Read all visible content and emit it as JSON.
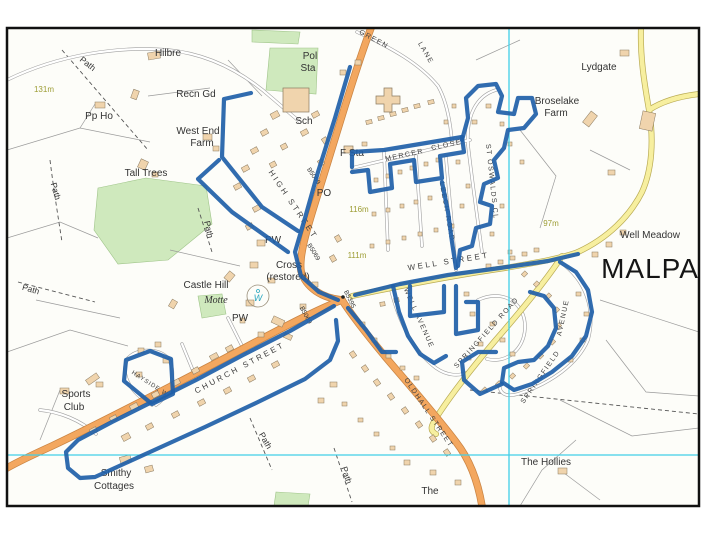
{
  "map": {
    "town_name": "MALPA",
    "description": "Street map of Malpas with blue highlighted walking route",
    "road_numbers": [
      "B5069",
      "B5395"
    ]
  },
  "colors": {
    "route_blue": "#1f5fa8",
    "road_orange": "#f3a75f",
    "road_orange_casing": "#c98443",
    "road_yellow": "#f7ef9f",
    "road_yellow_casing": "#b9ab54",
    "grid_cyan": "#41cfe8",
    "green_area": "#cfe9bd",
    "building": "#f0d4ad",
    "border": "#111111"
  },
  "grid": {
    "vertical_x": 509,
    "horizontal_y": 455
  },
  "labels": [
    {
      "t": "Hilbre",
      "x": 168,
      "y": 56,
      "r": 0,
      "c": "place"
    },
    {
      "t": "Path",
      "x": 86,
      "y": 66,
      "r": 38,
      "c": "path"
    },
    {
      "t": "131m",
      "x": 44,
      "y": 92,
      "r": 0,
      "c": "spot"
    },
    {
      "t": "Pp Ho",
      "x": 99,
      "y": 119,
      "r": 0,
      "c": "place"
    },
    {
      "t": "Recn Gd",
      "x": 196,
      "y": 97,
      "r": 0,
      "c": "place"
    },
    {
      "t": "West End",
      "x": 198,
      "y": 134,
      "r": 0,
      "c": "place"
    },
    {
      "t": "Farm",
      "x": 202,
      "y": 146,
      "r": 0,
      "c": "place"
    },
    {
      "t": "Tall Trees",
      "x": 146,
      "y": 176,
      "r": 0,
      "c": "place"
    },
    {
      "t": "Pol",
      "x": 310,
      "y": 59,
      "r": 0,
      "c": "place"
    },
    {
      "t": "Sta",
      "x": 308,
      "y": 71,
      "r": 0,
      "c": "place"
    },
    {
      "t": "Sch",
      "x": 304,
      "y": 124,
      "r": 0,
      "c": "place"
    },
    {
      "t": "F Sta",
      "x": 352,
      "y": 156,
      "r": 0,
      "c": "place"
    },
    {
      "t": "GREEN",
      "x": 373,
      "y": 41,
      "r": 28,
      "c": "street"
    },
    {
      "t": "LANE",
      "x": 424,
      "y": 54,
      "r": 60,
      "c": "street"
    },
    {
      "t": "Lydgate",
      "x": 599,
      "y": 70,
      "r": 0,
      "c": "place"
    },
    {
      "t": "Broselake",
      "x": 557,
      "y": 104,
      "r": 0,
      "c": "place"
    },
    {
      "t": "Farm",
      "x": 556,
      "y": 116,
      "r": 0,
      "c": "place"
    },
    {
      "t": "MERCER",
      "x": 405,
      "y": 157,
      "r": -12,
      "c": "street"
    },
    {
      "t": "CLOSE",
      "x": 447,
      "y": 147,
      "r": -12,
      "c": "street"
    },
    {
      "t": "LEECH ROAD",
      "x": 445,
      "y": 212,
      "r": 80,
      "c": "street"
    },
    {
      "t": "ST OSWALDS CL",
      "x": 490,
      "y": 182,
      "r": 84,
      "c": "street"
    },
    {
      "t": "HIGH STREET",
      "x": 291,
      "y": 206,
      "r": 56,
      "c": "street-lg"
    },
    {
      "t": "B5069",
      "x": 312,
      "y": 177,
      "r": 56,
      "c": "roadno"
    },
    {
      "t": "B5069",
      "x": 312,
      "y": 253,
      "r": 58,
      "c": "roadno"
    },
    {
      "t": "B5069",
      "x": 304,
      "y": 316,
      "r": 62,
      "c": "roadno"
    },
    {
      "t": "B5395",
      "x": 348,
      "y": 300,
      "r": 64,
      "c": "roadno"
    },
    {
      "t": "PO",
      "x": 324,
      "y": 196,
      "r": 0,
      "c": "place"
    },
    {
      "t": "116m",
      "x": 359,
      "y": 212,
      "r": 0,
      "c": "spot"
    },
    {
      "t": "111m",
      "x": 357,
      "y": 258,
      "r": 0,
      "c": "spot"
    },
    {
      "t": "97m",
      "x": 551,
      "y": 226,
      "r": 0,
      "c": "spot"
    },
    {
      "t": "PW",
      "x": 273,
      "y": 243,
      "r": 0,
      "c": "place"
    },
    {
      "t": "Cross",
      "x": 289,
      "y": 268,
      "r": 0,
      "c": "place"
    },
    {
      "t": "(restored)",
      "x": 288,
      "y": 280,
      "r": 0,
      "c": "place"
    },
    {
      "t": "Castle Hill",
      "x": 206,
      "y": 288,
      "r": 0,
      "c": "place"
    },
    {
      "t": "Motte",
      "x": 216,
      "y": 303,
      "r": 0,
      "c": "italic"
    },
    {
      "t": "W",
      "x": 258,
      "y": 301,
      "r": 0,
      "c": "well"
    },
    {
      "t": "PW",
      "x": 240,
      "y": 321,
      "r": 0,
      "c": "place"
    },
    {
      "t": "WELL STREET",
      "x": 449,
      "y": 264,
      "r": -9,
      "c": "street-lg"
    },
    {
      "t": "Well Meadow",
      "x": 650,
      "y": 238,
      "r": 0,
      "c": "place"
    },
    {
      "t": "MALPA",
      "x": 650,
      "y": 278,
      "r": 0,
      "c": "big"
    },
    {
      "t": "WELL AVENUE",
      "x": 417,
      "y": 319,
      "r": 66,
      "c": "street"
    },
    {
      "t": "SPRINGFIELD ROAD",
      "x": 488,
      "y": 334,
      "r": -48,
      "c": "street"
    },
    {
      "t": "SPRINGFIELD",
      "x": 542,
      "y": 378,
      "r": -55,
      "c": "street"
    },
    {
      "t": "AVENUE",
      "x": 565,
      "y": 318,
      "r": -78,
      "c": "street"
    },
    {
      "t": "OLDHALL STREET",
      "x": 427,
      "y": 414,
      "r": 56,
      "c": "street"
    },
    {
      "t": "CHURCH STREET",
      "x": 241,
      "y": 370,
      "r": -28,
      "c": "street-lg"
    },
    {
      "t": "HAYSIDE W",
      "x": 149,
      "y": 385,
      "r": 33,
      "c": "street-sm"
    },
    {
      "t": "Sports",
      "x": 76,
      "y": 397,
      "r": 0,
      "c": "place"
    },
    {
      "t": "Club",
      "x": 74,
      "y": 410,
      "r": 0,
      "c": "place"
    },
    {
      "t": "Smithy",
      "x": 116,
      "y": 476,
      "r": 0,
      "c": "place"
    },
    {
      "t": "Cottages",
      "x": 114,
      "y": 489,
      "r": 0,
      "c": "place"
    },
    {
      "t": "Path",
      "x": 53,
      "y": 192,
      "r": 74,
      "c": "path"
    },
    {
      "t": "Path",
      "x": 30,
      "y": 292,
      "r": 16,
      "c": "path"
    },
    {
      "t": "Path",
      "x": 206,
      "y": 230,
      "r": 78,
      "c": "path"
    },
    {
      "t": "Path",
      "x": 263,
      "y": 442,
      "r": 60,
      "c": "path"
    },
    {
      "t": "Path",
      "x": 344,
      "y": 476,
      "r": 72,
      "c": "path"
    },
    {
      "t": "The Hollies",
      "x": 546,
      "y": 465,
      "r": 0,
      "c": "place"
    },
    {
      "t": "The",
      "x": 430,
      "y": 494,
      "r": 0,
      "c": "place"
    }
  ],
  "route_overlay": {
    "color": "#1f5fa8",
    "width": 4.2,
    "paths": [
      [
        [
          350,
          67
        ],
        [
          335,
          118
        ],
        [
          318,
          172
        ],
        [
          305,
          218
        ],
        [
          295,
          252
        ],
        [
          301,
          276
        ],
        [
          319,
          292
        ],
        [
          338,
          300
        ]
      ],
      [
        [
          298,
          231
        ],
        [
          262,
          207
        ],
        [
          222,
          157
        ],
        [
          224,
          99
        ],
        [
          251,
          93
        ]
      ],
      [
        [
          288,
          252
        ],
        [
          232,
          212
        ],
        [
          198,
          179
        ],
        [
          219,
          160
        ]
      ],
      [
        [
          334,
          306
        ],
        [
          290,
          331
        ],
        [
          243,
          355
        ],
        [
          196,
          380
        ],
        [
          152,
          402
        ],
        [
          112,
          422
        ],
        [
          78,
          440
        ],
        [
          66,
          452
        ],
        [
          68,
          468
        ],
        [
          80,
          478
        ],
        [
          95,
          477
        ],
        [
          150,
          452
        ],
        [
          205,
          427
        ],
        [
          258,
          402
        ],
        [
          305,
          379
        ],
        [
          330,
          360
        ],
        [
          338,
          341
        ],
        [
          336,
          320
        ]
      ],
      [
        [
          152,
          404
        ],
        [
          124,
          381
        ],
        [
          126,
          360
        ],
        [
          150,
          351
        ],
        [
          171,
          359
        ],
        [
          173,
          394
        ],
        [
          152,
          404
        ]
      ],
      [
        [
          355,
          295
        ],
        [
          400,
          284
        ],
        [
          448,
          275
        ],
        [
          500,
          268
        ],
        [
          548,
          261
        ],
        [
          578,
          254
        ]
      ],
      [
        [
          348,
          308
        ],
        [
          366,
          330
        ],
        [
          382,
          352
        ],
        [
          396,
          352
        ]
      ],
      [
        [
          393,
          286
        ],
        [
          399,
          312
        ],
        [
          408,
          336
        ],
        [
          420,
          354
        ],
        [
          434,
          363
        ],
        [
          446,
          356
        ]
      ],
      [
        [
          410,
          286
        ],
        [
          410,
          316
        ],
        [
          444,
          312
        ],
        [
          444,
          286
        ]
      ],
      [
        [
          456,
          286
        ],
        [
          456,
          334
        ],
        [
          478,
          330
        ],
        [
          478,
          302
        ],
        [
          466,
          302
        ]
      ],
      [
        [
          352,
          167
        ],
        [
          352,
          152
        ],
        [
          384,
          150
        ],
        [
          438,
          141
        ],
        [
          462,
          137
        ]
      ],
      [
        [
          462,
          137
        ],
        [
          464,
          152
        ],
        [
          440,
          156
        ],
        [
          442,
          178
        ],
        [
          416,
          182
        ],
        [
          414,
          160
        ],
        [
          390,
          164
        ],
        [
          392,
          188
        ],
        [
          370,
          192
        ],
        [
          368,
          170
        ],
        [
          352,
          172
        ]
      ],
      [
        [
          442,
          182
        ],
        [
          448,
          212
        ],
        [
          452,
          242
        ],
        [
          456,
          268
        ]
      ],
      [
        [
          462,
          140
        ],
        [
          468,
          118
        ],
        [
          466,
          98
        ],
        [
          478,
          86
        ],
        [
          496,
          84
        ],
        [
          502,
          96
        ],
        [
          498,
          112
        ],
        [
          514,
          114
        ],
        [
          518,
          98
        ],
        [
          532,
          98
        ],
        [
          536,
          114
        ],
        [
          524,
          128
        ],
        [
          508,
          130
        ],
        [
          504,
          148
        ],
        [
          494,
          160
        ],
        [
          498,
          178
        ],
        [
          484,
          184
        ],
        [
          480,
          202
        ],
        [
          492,
          206
        ],
        [
          490,
          224
        ],
        [
          476,
          228
        ],
        [
          472,
          246
        ],
        [
          460,
          250
        ],
        [
          458,
          266
        ]
      ],
      [
        [
          560,
          262
        ],
        [
          576,
          272
        ],
        [
          588,
          290
        ],
        [
          592,
          312
        ],
        [
          586,
          336
        ],
        [
          572,
          356
        ],
        [
          552,
          372
        ],
        [
          532,
          384
        ],
        [
          514,
          390
        ],
        [
          502,
          382
        ],
        [
          504,
          368
        ],
        [
          518,
          362
        ],
        [
          534,
          360
        ],
        [
          548,
          346
        ],
        [
          556,
          328
        ],
        [
          554,
          308
        ],
        [
          544,
          296
        ],
        [
          530,
          292
        ]
      ],
      [
        [
          502,
          384
        ],
        [
          480,
          394
        ],
        [
          464,
          380
        ],
        [
          462,
          362
        ],
        [
          478,
          352
        ],
        [
          496,
          352
        ]
      ]
    ]
  }
}
